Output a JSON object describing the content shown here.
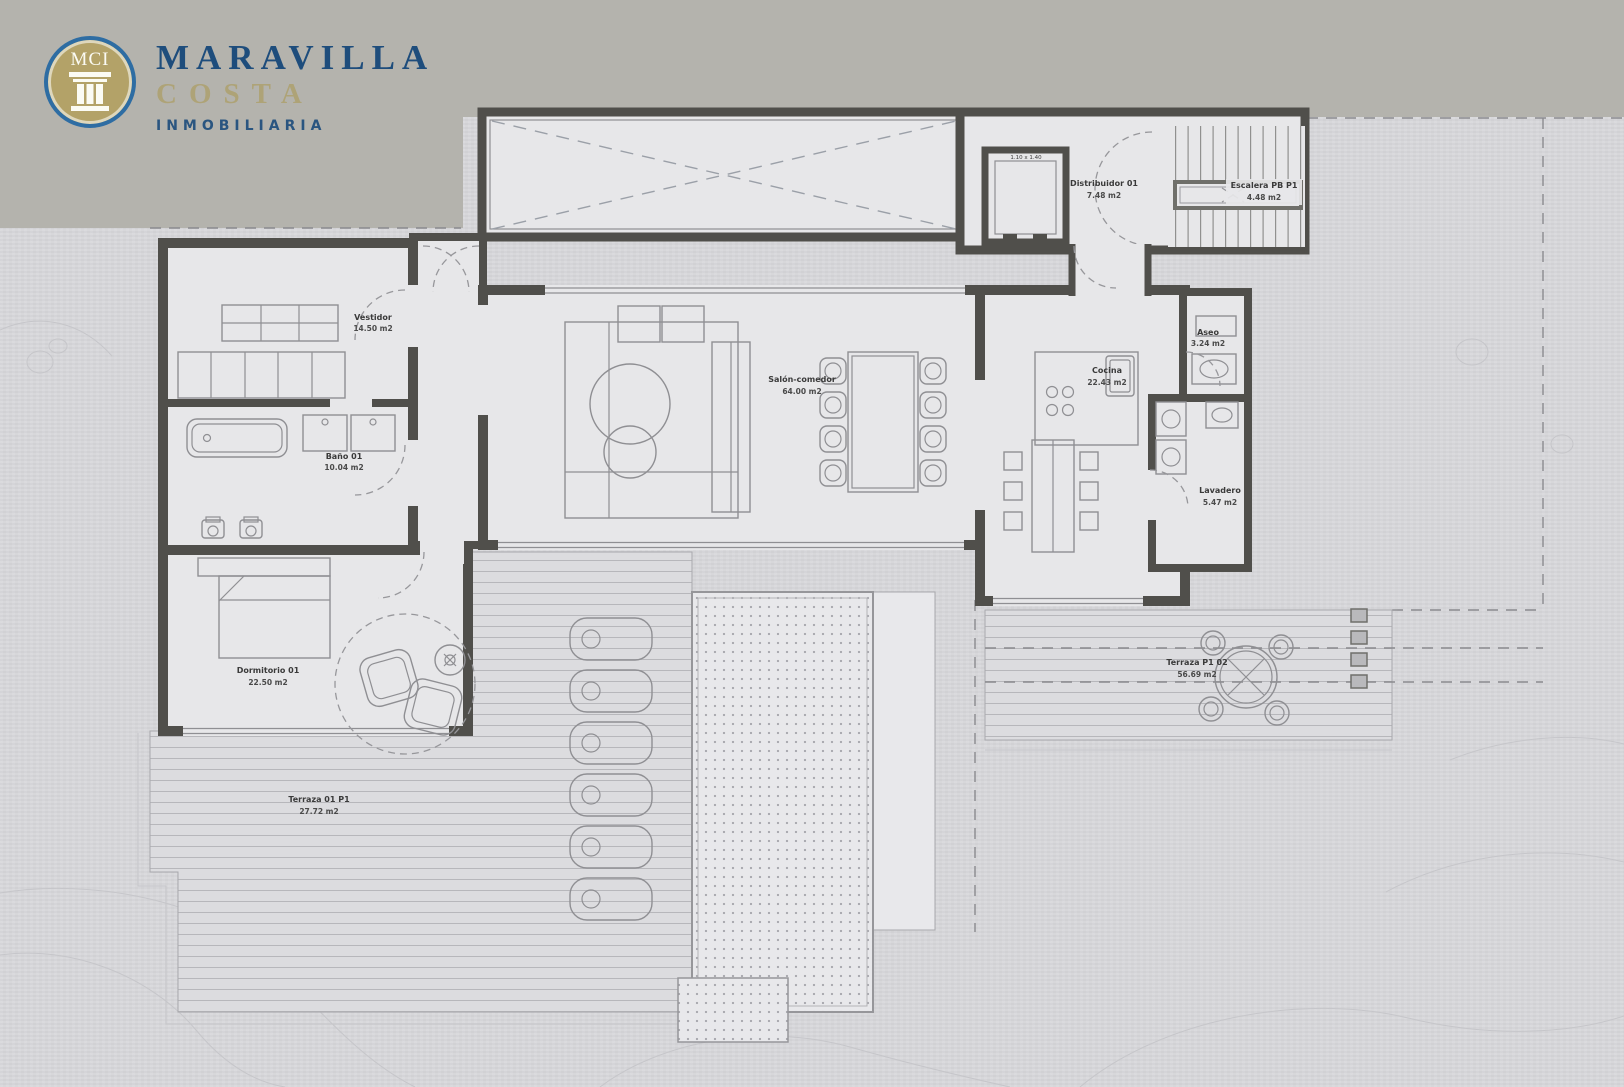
{
  "logo": {
    "monogram": "MCI",
    "title": "MARAVILLA",
    "subtitle": "COSTA",
    "tagline": "INMOBILIARIA"
  },
  "rooms": [
    {
      "id": "vestidor",
      "name": "Vestidor",
      "area": "14.50 m2"
    },
    {
      "id": "banyo",
      "name": "Baño 01",
      "area": "10.04 m2"
    },
    {
      "id": "dormitorio",
      "name": "Dormitorio 01",
      "area": "22.50 m2"
    },
    {
      "id": "salon",
      "name": "Salón-comedor",
      "area": "64.00 m2"
    },
    {
      "id": "cocina",
      "name": "Cocina",
      "area": "22.43 m2"
    },
    {
      "id": "aseo",
      "name": "Aseo",
      "area": "3.24 m2"
    },
    {
      "id": "lavadero",
      "name": "Lavadero",
      "area": "5.47 m2"
    },
    {
      "id": "distribuidor",
      "name": "Distribuidor 01",
      "area": "7.48 m2"
    },
    {
      "id": "escalera",
      "name": "Escalera PB P1",
      "area": "4.48 m2"
    },
    {
      "id": "terraza_01",
      "name": "Terraza 01 P1",
      "area": "27.72 m2"
    },
    {
      "id": "terraza_02",
      "name": "Terraza P1 02",
      "area": "56.69 m2"
    }
  ],
  "annotations": {
    "elevator_dimension": "1.10 x 1.40"
  },
  "colors": {
    "paper": "#d9d9dc",
    "band": "#b4b3ad",
    "wall": "#504f4b",
    "floor": "#e7e7e9",
    "logo_blue": "#1e4d7c",
    "logo_gold": "#b3a268"
  }
}
